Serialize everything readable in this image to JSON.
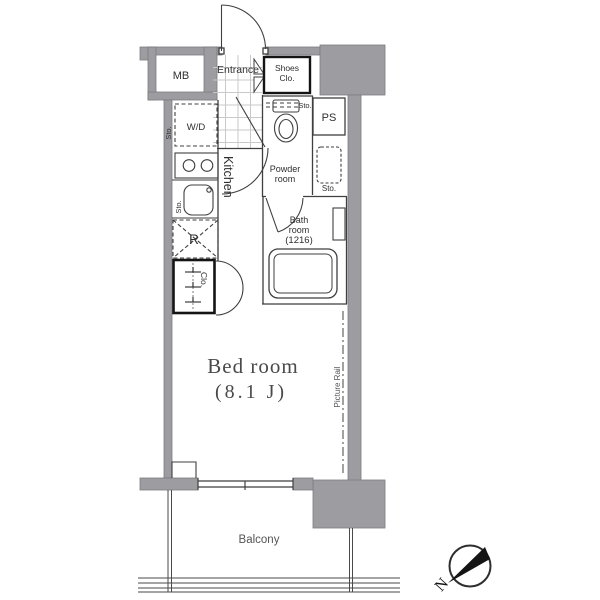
{
  "colors": {
    "wall": "#9d9da1",
    "wall_edge": "#7b7b80",
    "line": "#3f3f3f",
    "light_line": "#c9c9c9",
    "text": "#2f2f2f",
    "muted": "#555555",
    "black": "#141414"
  },
  "labels": {
    "mb": "MB",
    "entrance": "Entrance",
    "shoes_line1": "Shoes",
    "shoes_line2": "Clo.",
    "ps": "PS",
    "wd": "W/D",
    "kitchen": "Kitchen",
    "sto": "Sto.",
    "powder_line1": "Powder",
    "powder_line2": "room",
    "bath_line1": "Bath",
    "bath_line2": "room",
    "bath_size": "(1216)",
    "fridge": "R",
    "closet": "Clo.",
    "bed_room": "Bed room",
    "bed_size": "(8.1 J)",
    "picture_rail": "Picture Rail",
    "balcony": "Balcony",
    "north": "N"
  }
}
